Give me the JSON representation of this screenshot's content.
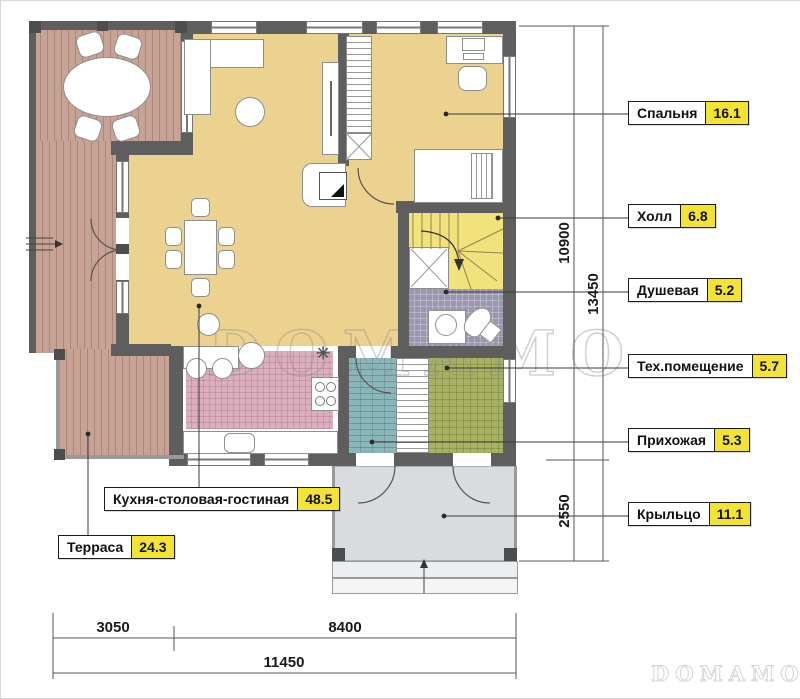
{
  "rooms": [
    {
      "name": "Спальня",
      "area": "16.1"
    },
    {
      "name": "Холл",
      "area": "6.8"
    },
    {
      "name": "Душевая",
      "area": "5.2"
    },
    {
      "name": "Тех.помещение",
      "area": "5.7"
    },
    {
      "name": "Прихожая",
      "area": "5.3"
    },
    {
      "name": "Крыльцо",
      "area": "11.1"
    },
    {
      "name": "Кухня-столовая-гостиная",
      "area": "48.5"
    },
    {
      "name": "Терраса",
      "area": "24.3"
    }
  ],
  "dims": {
    "bottom": [
      "3050",
      "8400",
      "11450"
    ],
    "right": [
      "10900",
      "2550",
      "13450"
    ]
  },
  "watermark": {
    "center": "DOMAMO",
    "corner": "DOMAMO"
  },
  "symbols": {
    "snowflake": "✳"
  },
  "colors": {
    "wall": "#5e5e5e",
    "label_value_bg": "#f2e334",
    "wood_floor": "#ecd28f",
    "terrace_deck": "#c7a396",
    "kitchen_tile": "#dab0bf",
    "entry_tile": "#8ab6ba",
    "tech_tile": "#a9b163",
    "shower_tile": "#9a98b0",
    "stairs_floor": "#f1e27b",
    "porch_floor": "#d9dcdf"
  }
}
